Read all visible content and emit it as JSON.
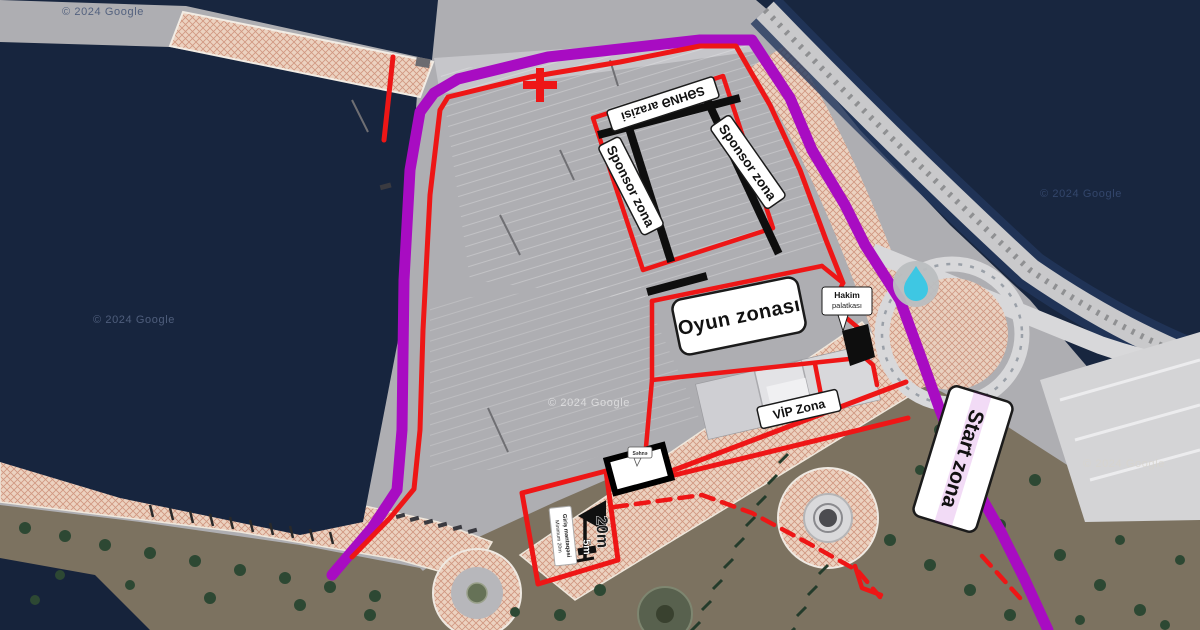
{
  "map": {
    "attribution": "© 2024 Google",
    "colors": {
      "route": "#A80CC2",
      "boundary": "#EE1616",
      "structure": "#0E0E0E",
      "water_drop": "#3EC7E3"
    },
    "labels": {
      "stage_area": "SƏHNƏ arazisi",
      "sponsor_zone_left": "Sponsor zona",
      "sponsor_zone_right": "Sponsor zona",
      "game_zone": "Oyun zonası",
      "judge_tent": {
        "line1": "Hakim",
        "line2": "palatkası"
      },
      "vip_zone": "VİP Zona",
      "start_zone": "Start zona",
      "entry_point": {
        "line1": "Giriş məntəqəsi",
        "line2": "Minimum 20m"
      },
      "stage_callout": "Səhnə"
    },
    "measurements": {
      "long": "20m",
      "short": "5m"
    },
    "icons": {
      "water_station": "water-drop",
      "course_marker": "red-cross"
    }
  }
}
